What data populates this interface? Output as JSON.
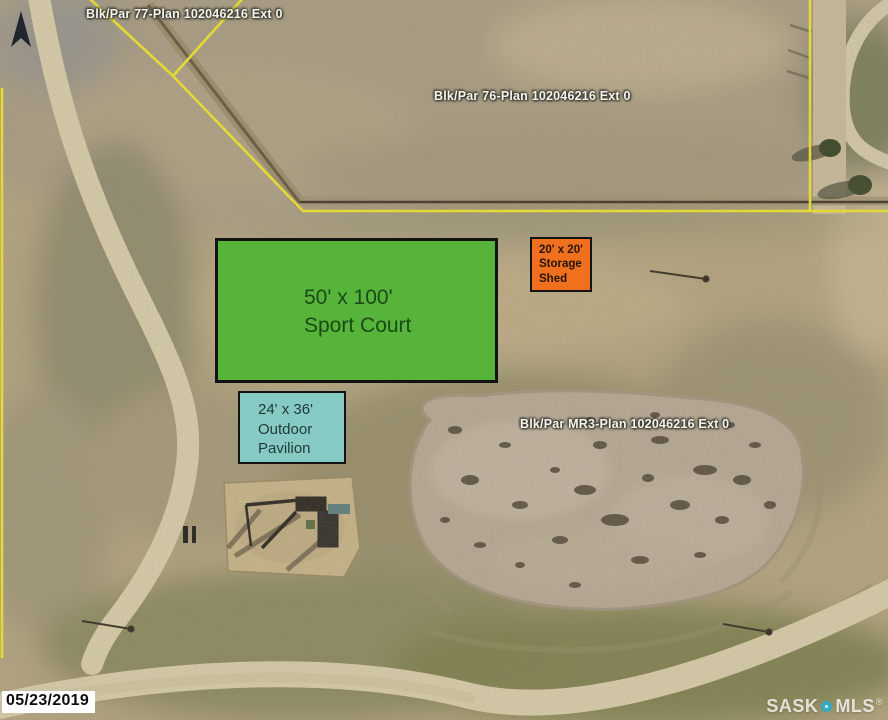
{
  "colors": {
    "boundary_yellow": "#f0e32c",
    "court_green": "#57b43a",
    "shed_orange": "#f1701f",
    "pavilion_teal": "#87cac3",
    "pin_teal": "#35a8c2"
  },
  "parcels": [
    {
      "label": "Blk/Par 77-Plan 102046216 Ext 0"
    },
    {
      "label": "Blk/Par 76-Plan 102046216 Ext 0"
    },
    {
      "label": "Blk/Par MR3-Plan 102046216 Ext 0"
    }
  ],
  "annotations": {
    "sport_court": {
      "dimensions": "50' x 100'",
      "name": "Sport Court"
    },
    "storage_shed": {
      "dimensions": "20' x 20'",
      "name_line1": "Storage",
      "name_line2": "Shed"
    },
    "pavilion": {
      "dimensions": "24' x 36'",
      "name_line1": "Outdoor",
      "name_line2": "Pavilion"
    }
  },
  "stamps": {
    "date": "05/23/2019",
    "watermark_left": "SASK",
    "watermark_right": "MLS",
    "watermark_reg": "®"
  },
  "icons": {
    "north_arrow": "compass-dart-up"
  }
}
